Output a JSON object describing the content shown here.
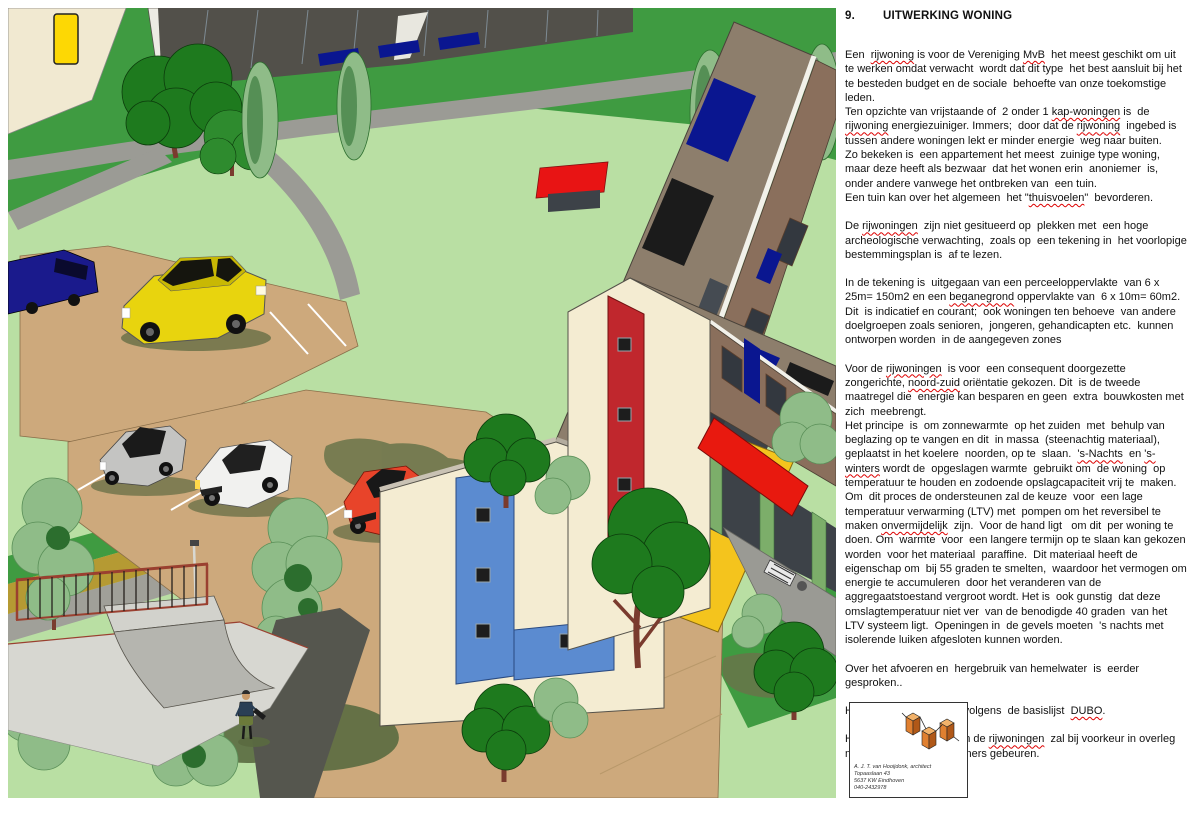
{
  "article": {
    "section_number": "9.",
    "title": "UITWERKING WONING",
    "paragraphs": [
      {
        "text": "Een  rijwoning is voor de Vereniging MvB  het meest geschikt om uit te werken omdat verwacht  wordt dat dit type  het best aansluit bij het te besteden budget en de sociale  behoefte van onze toekomstige leden.\nTen opzichte van vrijstaande of  2 onder 1 kap-woningen is  de rijwoning energiezuiniger. Immers;  door dat de rijwoning  ingebed is tussen andere woningen lekt er minder energie  weg naar buiten.\nZo bekeken is  een appartement het meest  zuinige type woning,  maar deze heeft als bezwaar  dat het wonen erin  anoniemer  is, onder andere vanwege het ontbreken van  een tuin.\nEen tuin kan over het algemeen  het \"thuisvoelen\"  bevorderen.",
        "marked": [
          "rijwoning",
          "MvB",
          "kap-woningen",
          "thuisvoelen"
        ]
      },
      {
        "text": "De rijwoningen  zijn niet gesitueerd op  plekken met  een hoge archeologische verwachting,  zoals op  een tekening in  het voorlopige bestemmingsplan is  af te lezen.",
        "marked": [
          "rijwoningen"
        ]
      },
      {
        "text": "In de tekening is  uitgegaan van een perceeloppervlakte  van 6 x  25m= 150m2 en een beganegrond oppervlakte van  6 x 10m= 60m2.  Dit  is indicatief en courant;  ook woningen ten behoeve  van andere doelgroepen zoals senioren,  jongeren, gehandicapten etc.  kunnen ontworpen worden  in de aangegeven zones",
        "marked": [
          "beganegrond"
        ]
      },
      {
        "text": "Voor de rijwoningen  is voor  een consequent doorgezette zongerichte, noord-zuid oriëntatie gekozen. Dit  is de tweede  maatregel die  energie kan besparen en geen  extra  bouwkosten met zich  meebrengt.\nHet principe  is  om zonnewarmte  op het zuiden  met  behulp van beglazing op te vangen en dit  in massa  (steenachtig materiaal), geplaatst in het koelere  noorden, op te  slaan.  's-Nachts  en 's-winters wordt de  opgeslagen warmte  gebruikt om  de woning  op  temperatuur te houden en zodoende opslagcapaciteit vrij te  maken.  Om  dit proces de ondersteunen zal de keuze  voor  een lage temperatuur verwarming (LTV) met  pompen om het reversibel te  maken onvermijdelijk  zijn.  Voor de hand ligt   om dit  per woning te doen. Om  warmte  voor  een langere termijn op te slaan kan gekozen worden  voor het materiaal  paraffine.  Dit materiaal heeft de eigenschap om  bij 55 graden te smelten,  waardoor het vermogen om energie te accumuleren  door het veranderen van de aggregaatstoestand vergroot wordt. Het is  ook gunstig  dat deze omslagtemperatuur niet ver  van de benodigde 40 graden  van het LTV systeem ligt.  Openingen in  de gevels moeten  's nachts met isolerende luiken afgesloten kunnen worden.",
        "marked": [
          "rijwoningen",
          "noord-zuid",
          "'s-Nachts",
          "'s-winters",
          "onvermijdelijk"
        ]
      },
      {
        "text": "Over het afvoeren en  hergebruik van hemelwater  is  eerder  gesproken..",
        "marked": []
      },
      {
        "text": "Het materiaalgebruik  is volgens  de basislijst  DUBO.",
        "marked": [
          "DUBO"
        ]
      },
      {
        "text": "Het verder uitwerken  van de rijwoningen  zal bij voorkeur in overleg met participerende bewoners gebeuren.",
        "marked": [
          "rijwoningen"
        ]
      }
    ]
  },
  "logo_box": {
    "lines": [
      "A. J. T. van Hooijdonk, architect",
      "Topaaslaan 43",
      "5637 KW Eindhoven",
      "040-2432978"
    ]
  },
  "illustration": {
    "description": "Bird's-eye 3D rendering of sun-oriented terraced houses (rijwoningen) with roof solar panels, accent stripes, awnings, glass porches, parking lots with cars, trees, a skate ramp and a pedestrian",
    "objects": [
      "row-house-block-blue-stripe",
      "row-house-block-red-stripe",
      "distant-glazed-row",
      "yellow-awning",
      "red-awnings",
      "solar-panels",
      "parking-lot",
      "silver-car",
      "white-car",
      "red-car",
      "yellow-car",
      "blue-van",
      "trees",
      "poplars",
      "skate-ramp",
      "railing",
      "lampposts",
      "pedestrian",
      "terrace-lounge-chair",
      "yellow-road-sign"
    ],
    "colors": {
      "grass_light": "#b9dfa3",
      "grass_dark": "#3f9b41",
      "road_gray": "#9b9b95",
      "path_dark": "#55564e",
      "walk_olive": "#b59a33",
      "parking_tan": "#cda97c",
      "roof_taupe": "#8d7e6c",
      "facade_brown": "#8a6f5c",
      "wall_cream": "#f4ecd2",
      "panel_navy": "#0a1690",
      "panel_black": "#1b1b1b",
      "accent_blue": "#5b8bd0",
      "accent_red": "#c0272d",
      "awning_red": "#e8190f",
      "awning_yellow": "#f4c41d",
      "porch_green": "#7cae6a",
      "glass_dark": "#3d4248",
      "tree_dark": "#1e7a1e",
      "tree_sage": "#8fbc88",
      "trunk": "#7a3b2e",
      "shadow_olive": "#68744a",
      "cube_orange": "#e08030"
    }
  }
}
